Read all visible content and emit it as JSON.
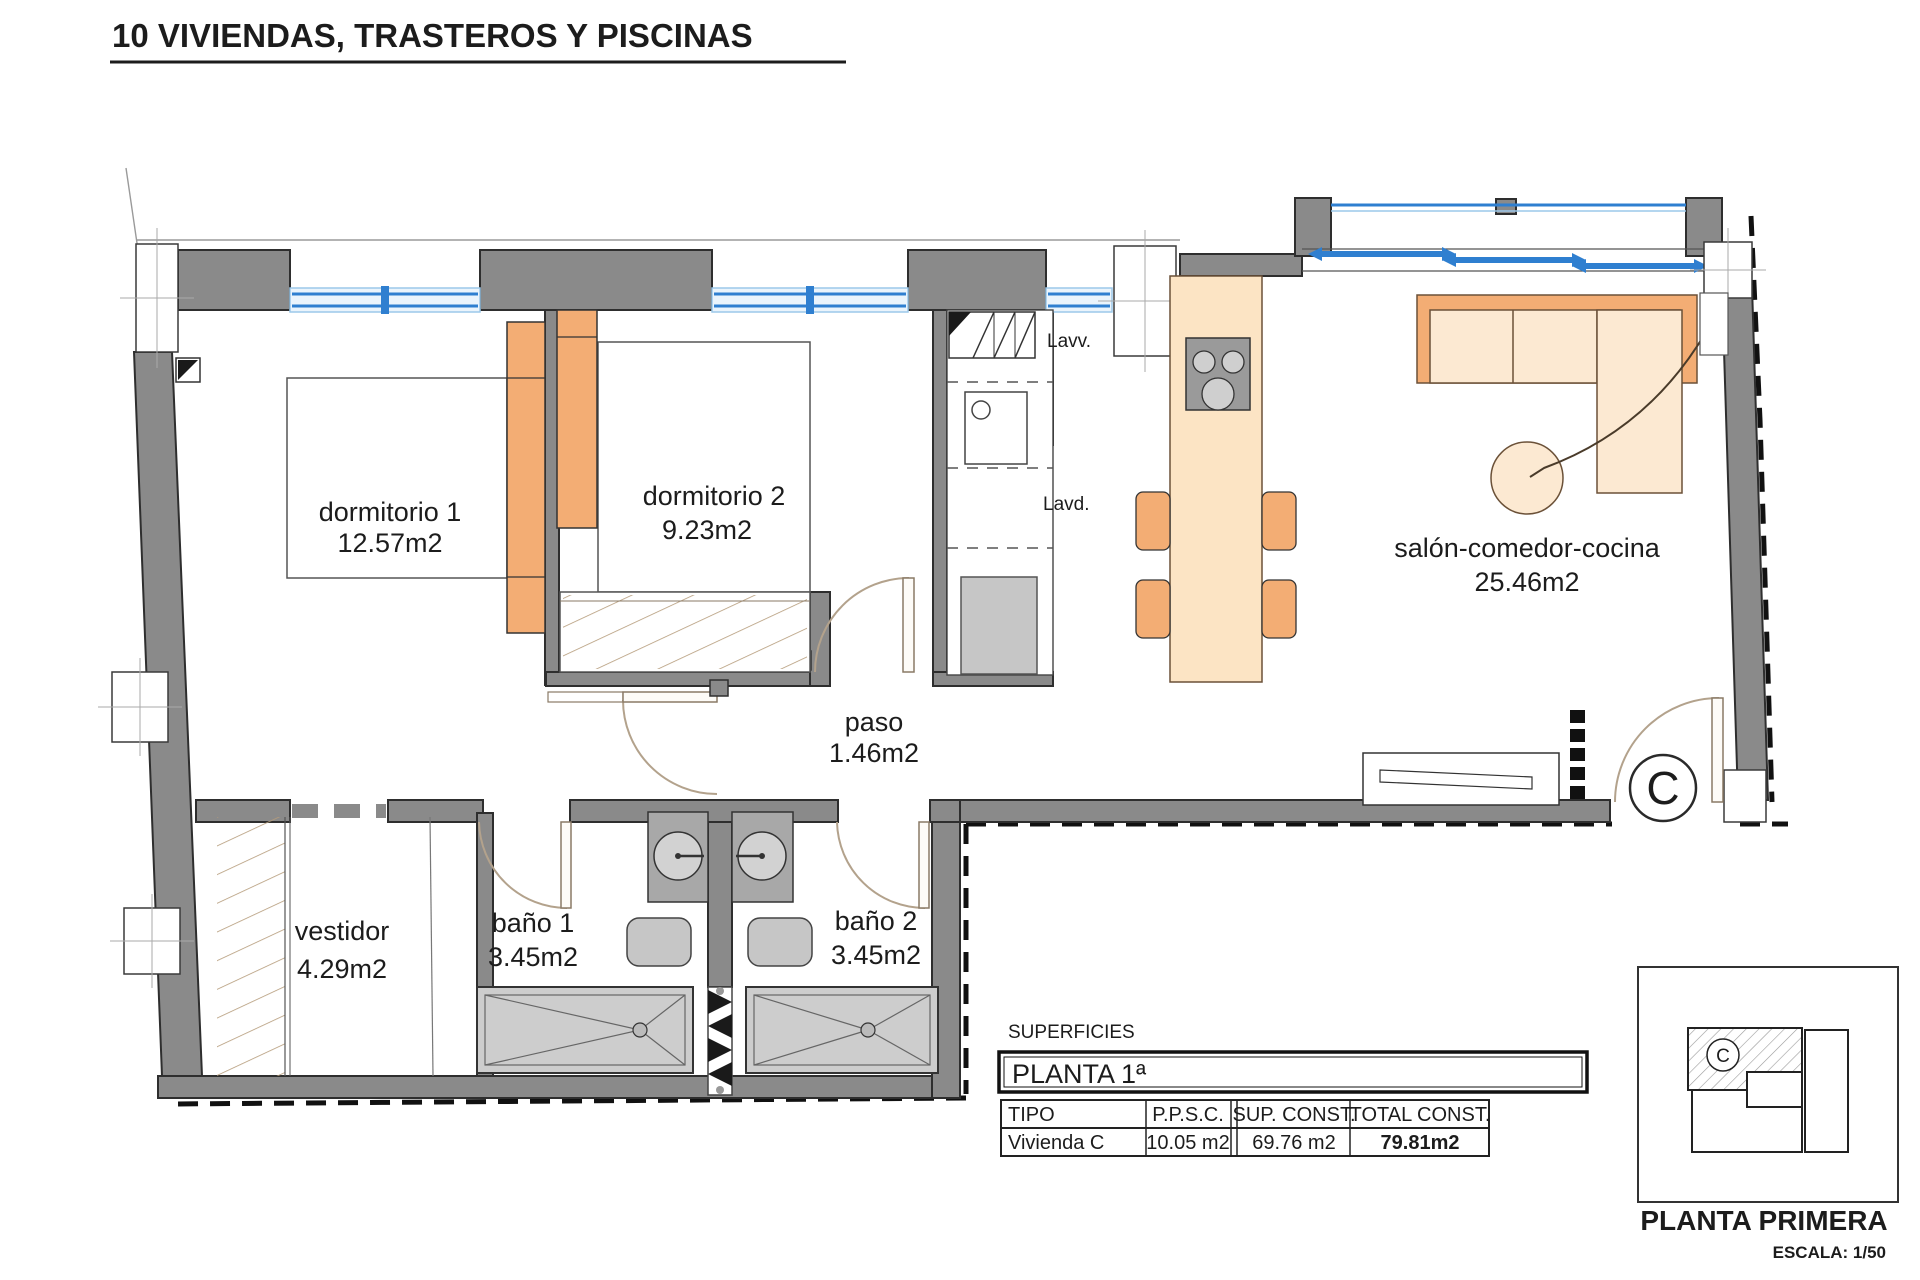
{
  "title": "10 VIVIENDAS, TRASTEROS Y PISCINAS",
  "rooms": {
    "dorm1": {
      "name": "dormitorio 1",
      "area": "12.57m2"
    },
    "dorm2": {
      "name": "dormitorio 2",
      "area": "9.23m2"
    },
    "salon": {
      "name": "salón-comedor-cocina",
      "area": "25.46m2"
    },
    "paso": {
      "name": "paso",
      "area": "1.46m2"
    },
    "vestidor": {
      "name": "vestidor",
      "area": "4.29m2"
    },
    "bano1": {
      "name": "baño 1",
      "area": "3.45m2"
    },
    "bano2": {
      "name": "baño 2",
      "area": "3.45m2"
    }
  },
  "fixtures": {
    "lavv": "Lavv.",
    "lavd": "Lavd."
  },
  "unit_letter": "C",
  "surface_table": {
    "caption": "SUPERFICIES",
    "floor_header": "PLANTA 1ª",
    "headers": [
      "TIPO",
      "P.P.S.C.",
      "SUP. CONST.",
      "TOTAL CONST."
    ],
    "rows": [
      [
        "Vivienda C",
        "10.05 m2",
        "69.76 m2",
        "79.81m2"
      ]
    ]
  },
  "key_plan": {
    "label": "PLANTA PRIMERA",
    "scale": "ESCALA: 1/50",
    "unit_letter": "C"
  },
  "colors": {
    "wall_gray": "#8a8a8a",
    "fixture_gray": "#c6c6c6",
    "window_blue": "#2f7fd0",
    "window_blue_light": "#9cc8ea",
    "furniture_beige": "#fce4c4",
    "furniture_orange": "#f3ad74",
    "hatch_tan": "#b59b7a",
    "line_dark": "#1c1c1c"
  }
}
